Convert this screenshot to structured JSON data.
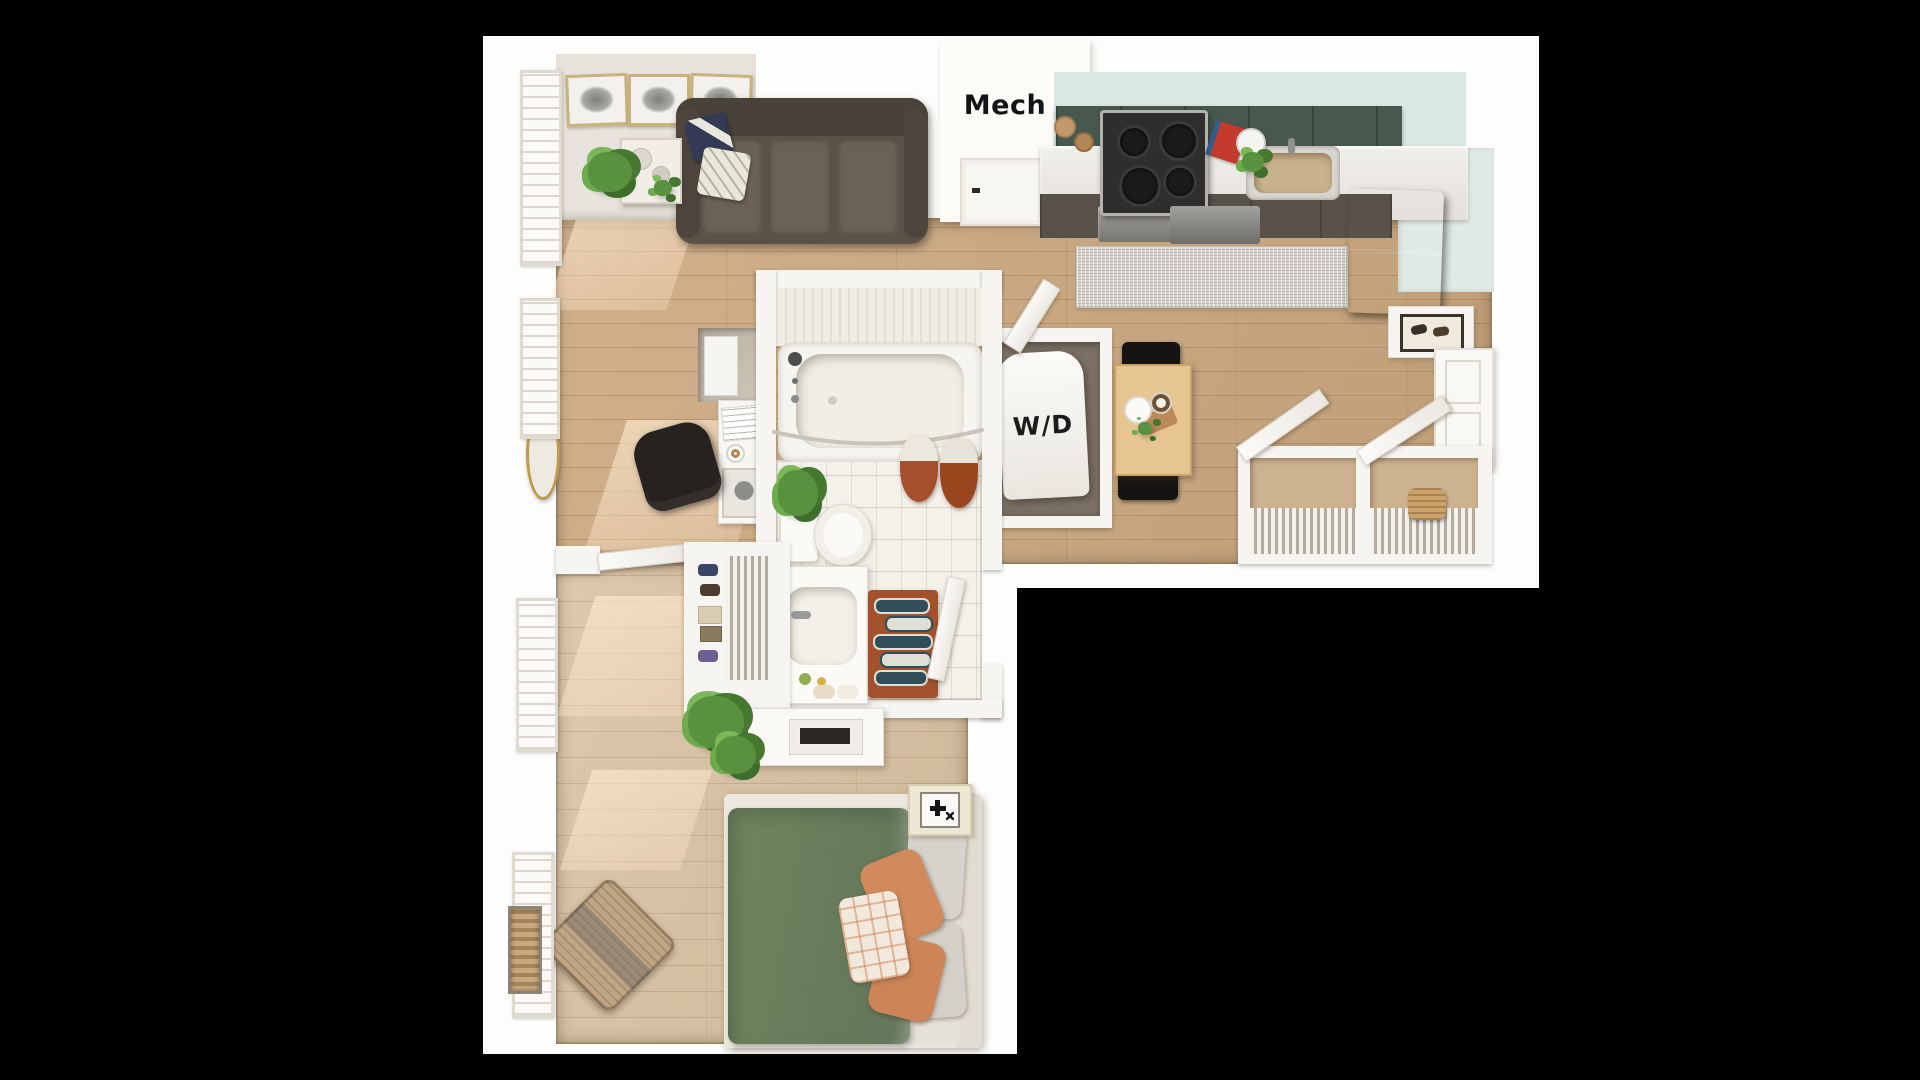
{
  "title": "apartment-floor-plan-3d-top-view",
  "canvas": {
    "width": 1920,
    "height": 1080,
    "background": "#000000"
  },
  "labels": {
    "mech_room": "Mech",
    "washer_dryer_unit": "W/D"
  },
  "palette": {
    "backdrop_white": "#fdfdfc",
    "wall_white": "#f7f5f1",
    "wood_floor_main": "#cba87f",
    "wood_floor_bedroom": "#d9c1a1",
    "bathroom_tile": "#f3f1ea",
    "kitchen_backsplash_seafoam": "#dae9e4",
    "kitchen_cabinet_green": "#47594f",
    "kitchen_counter": "#edebe6",
    "kitchen_rug_gray": "#d6d3cc",
    "sofa_brown": "#5a5246",
    "bed_duvet_green": "#6a7e5f",
    "pillow_orange": "#d28a5d",
    "pillow_gray": "#d6d3cc",
    "bath_rug_terracotta": "#a3512d",
    "bath_rug_navy": "#2f4e5a",
    "bath_rug_cream": "#dfe0d5",
    "shower_curtain_rust": "#a5502d",
    "table_wood": "#e6c591",
    "chair_black": "#161412",
    "mirror_gold": "#bf9a4a",
    "sink_basin_brass": "#c9b28e",
    "appliance_stainless": "#9e9c99",
    "fridge_dark": "#41392f"
  },
  "rooms": {
    "living_room": {
      "furniture": [
        "sofa",
        "throw-pillows",
        "gallery-art-frames",
        "side-table",
        "potted-plant",
        "desk",
        "desk-chair",
        "floor-mirror",
        "windows"
      ]
    },
    "mechanical_closet": {
      "label_key": "mech_room",
      "furniture": [
        "closet-door"
      ]
    },
    "kitchen": {
      "furniture": [
        "upper-cabinets",
        "cooktop-stove",
        "oven",
        "sink",
        "dishwasher",
        "refrigerator",
        "runner-rug",
        "counter-accessories"
      ]
    },
    "dining_nook": {
      "furniture": [
        "table",
        "two-black-chairs",
        "serving-tray"
      ]
    },
    "laundry_closet": {
      "label_key": "washer_dryer_unit",
      "furniture": [
        "washer-dryer-unit",
        "open-door"
      ]
    },
    "entry": {
      "furniture": [
        "console-table",
        "shoe-tray",
        "entry-door"
      ]
    },
    "hall_closets": {
      "furniture": [
        "wire-shelving",
        "storage-basket",
        "open-doors"
      ]
    },
    "bathroom": {
      "furniture": [
        "bathtub",
        "curtain-rod",
        "shower-curtain",
        "toilet",
        "toilet-plant",
        "vanity-sink",
        "towels",
        "patterned-bath-rug",
        "open-door"
      ]
    },
    "bedroom": {
      "furniture": [
        "bed-green-duvet",
        "gray-pillows",
        "orange-pillows",
        "plaid-pillow",
        "nightstand",
        "dresser",
        "woven-pouf",
        "reach-in-closet",
        "trailing-plant",
        "windows",
        "wall-vent-niche"
      ]
    }
  }
}
